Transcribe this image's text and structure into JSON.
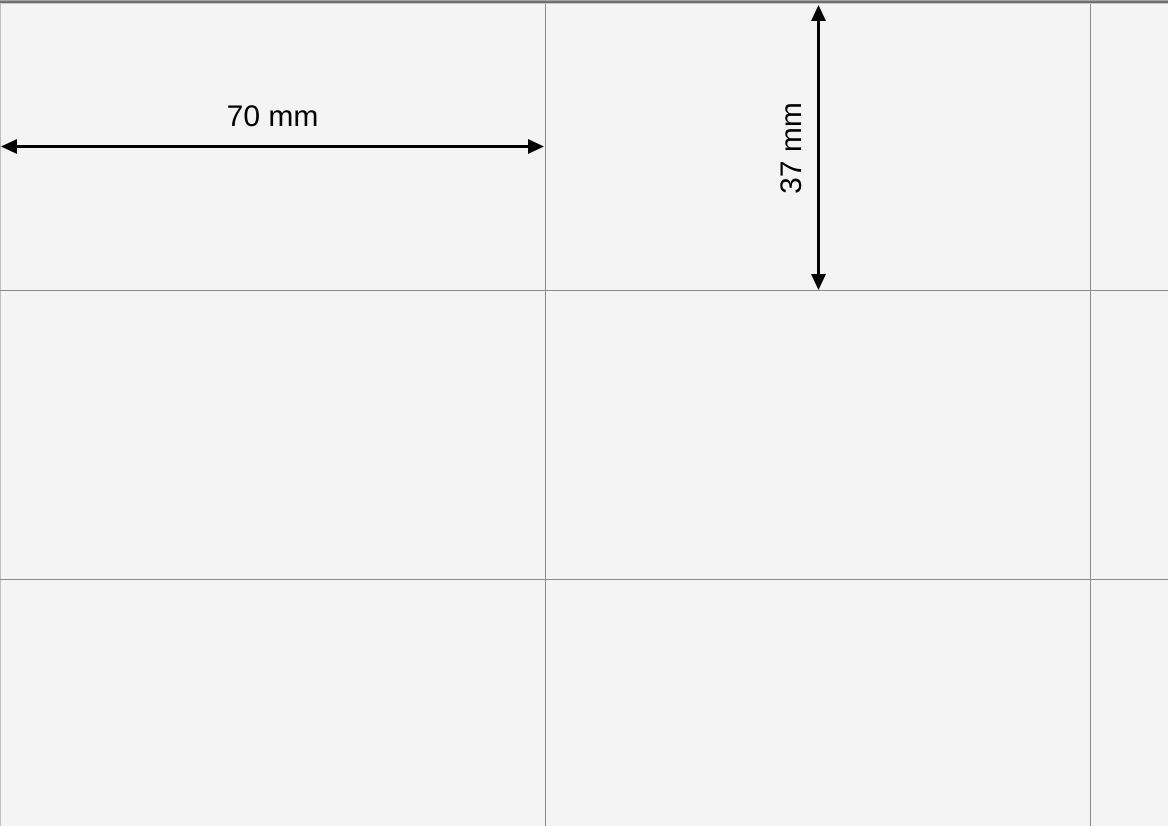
{
  "diagram": {
    "type": "label-sheet-dimension-diagram",
    "background_color": "#f4f4f4",
    "grid_line_color": "#8a8a8a",
    "page_edge_color": "#6f6f6f",
    "arrow_color": "#000000",
    "dimensions": {
      "width_label": "70 mm",
      "height_label": "37 mm"
    },
    "grid": {
      "visible_columns": 3,
      "visible_rows": 3,
      "cell_width_mm": 70,
      "cell_height_mm": 37
    }
  }
}
